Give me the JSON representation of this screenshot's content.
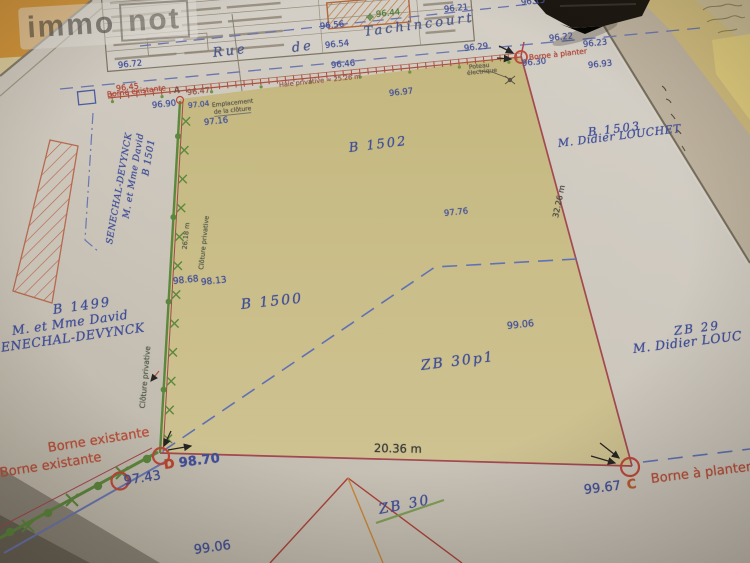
{
  "brand": {
    "immo": "immo",
    "not": "not"
  },
  "street": {
    "word1": "Rue",
    "word2": "de",
    "word3": "Tachincourt"
  },
  "parcels": {
    "b1502": "B 1502",
    "b1500": "B 1500",
    "zb30p1": "ZB 30p1",
    "zb30_struck": "ZB 30",
    "b1503_id": "B 1503",
    "b1503_owner": "M. Didier LOUCHET",
    "zb29_id": "ZB 29",
    "zb29_owner": "M. Didier LOUC",
    "b1501_id": "B 1501",
    "b1501_owner_line1": "M. et Mme David",
    "b1501_owner_line2": "SENECHAL-DEVYNCK",
    "b1499_id": "B 1499",
    "b1499_owner_line1": "M. et Mme David",
    "b1499_owner_line2": "SENECHAL-DEVYNCK"
  },
  "elevations": {
    "e96_72": "96.72",
    "e96_56": "96.56",
    "e96_54": "96.54",
    "e96_44": "96.44",
    "e96_21": "96.21",
    "e96_46": "96.46",
    "e96_29": "96.29",
    "e96_15": "96.15",
    "e96_22": "96.22",
    "e96_23": "96.23",
    "e96_30": "96.30",
    "e96_93": "96.93",
    "e96_97": "96.97",
    "e96_45": "96.45",
    "e96_47": "96.47",
    "e96_90": "96.90",
    "e97_04": "97.04",
    "e97_16": "97.16",
    "e97_76": "97.76",
    "e98_68": "98.68",
    "e98_13": "98.13",
    "e99_06": "99.06",
    "e97_43": "97.43",
    "e98_70": "98.70",
    "e99_67": "99.67",
    "e99_06b": "99.06"
  },
  "annotations": {
    "borne_existante": "Borne existante",
    "borne_a_planter": "Borne à planter",
    "haie_privative": "Haie privative ≈ 25.26 m",
    "emplacement_line1": "Emplacement",
    "emplacement_line2": "de la clôture",
    "cloture_privative": "Clôture privative",
    "poteau_line1": "Poteau",
    "poteau_line2": "électrique",
    "point_a": "A",
    "point_c": "C",
    "point_d": "D"
  },
  "measurements": {
    "bottom": "20.36 m",
    "right": "32.26 m",
    "left_fence": "26.18 m"
  },
  "colors": {
    "boundary_red": "#a84853",
    "parcel_fill": "#cfc48f",
    "text_blue": "#3f4f9f",
    "label_red": "#b5483a",
    "fence_green": "#5c8c3e",
    "dashed_blue": "#5f74c0",
    "folder_orange": "#d6973b"
  }
}
